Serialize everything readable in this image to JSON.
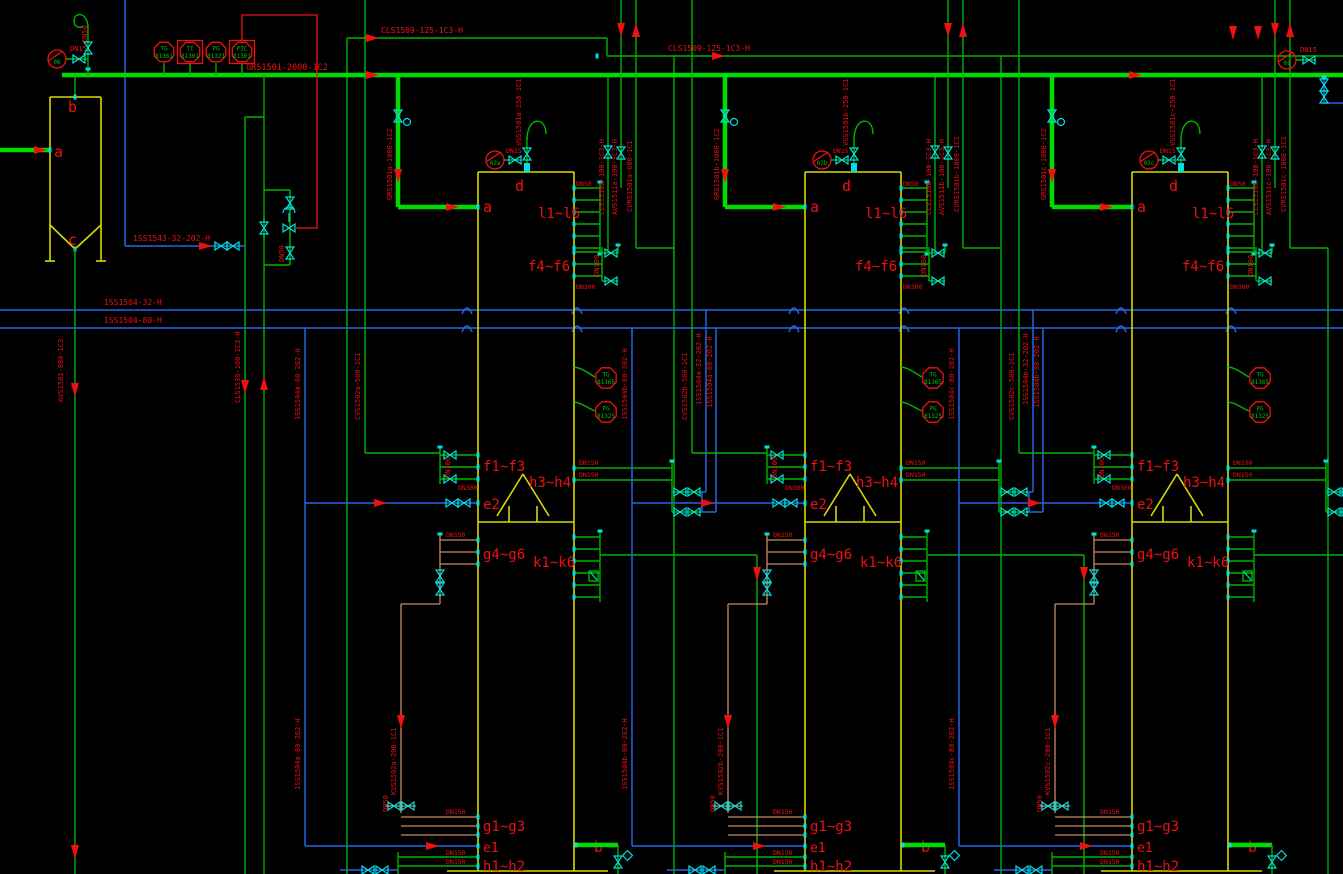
{
  "drawing": {
    "main_header_label": "GRS1501-2000-1C2",
    "cls_header_label": "CLS1509-125-1C3-H",
    "cls_header_label_2": "CLS1509-125-1C3-H",
    "blue_header_1": "1SS1504-32-H",
    "blue_header_2": "1SS1504-80-H",
    "blue_branch": "1SS1543-32-202-H",
    "avs_left": "AVS1501-800-1C3",
    "cls_left": "CLS1539-100-1C3-H",
    "left_inst": "06",
    "right_inst": "01",
    "dn15": "DN15",
    "dn50": "DN50",
    "dn100": "DN100",
    "dn150": "DN150",
    "dn300": "DN300",
    "vessel": {
      "top": "b",
      "inlet": "a",
      "bottom": "c"
    },
    "inst_row": [
      {
        "tag": "TG",
        "num": "81361"
      },
      {
        "tag": "TI",
        "num": "81301"
      },
      {
        "tag": "PG",
        "num": "81321"
      },
      {
        "tag": "PIC",
        "num": "81301"
      }
    ],
    "nozzles": {
      "top": "d",
      "inlet": "a",
      "outlet": "b",
      "e1": "e1",
      "e2": "e2",
      "l": "l1~l6",
      "f_upper": "f4~f6",
      "f_mid": "f1~f3",
      "h_mid": "h3~h4",
      "k": "k1~k6",
      "g_mid": "g4~g6",
      "g_bot": "g1~g3",
      "h_bot": "h1~h2"
    },
    "columns": [
      {
        "inst": "02a",
        "feed": "GRS1501a-1000-1C2",
        "vent": "VGS1501a-250-1C1",
        "cls": "CLS1510a-100-1C3-H",
        "avs": "AVS1511a-100-1C3-H",
        "cvrs": "CVRS1501a-600-1C1",
        "cvs": "CVS1502a-500-1C1",
        "kvs": "KVS1502a-200-1C1",
        "ss32": "1SS1504a-32-202-H",
        "ss80": "1SS1504a-80-202-H",
        "tg": "TG",
        "tg_num": "81365",
        "pg": "PG",
        "pg_num": "81325"
      },
      {
        "inst": "02b",
        "feed": "GRS1501b-1000-1C2",
        "vent": "VGS1501b-250-1C1",
        "cls": "CLS1510b-100-1C3-H",
        "avs": "AVS1511b-100-1C3-H",
        "cvrs": "CVRS1501b-1000-1C1",
        "cvs": "CVS1502b-500-1C1",
        "kvs": "KVS1502b-200-1C1",
        "ss32": "1SS1504b-32-202-H",
        "ss80": "1SS1504b-80-202-H",
        "tg": "TG",
        "tg_num": "81365",
        "pg": "PG",
        "pg_num": "81325"
      },
      {
        "inst": "02c",
        "feed": "GRS1501c-1000-1C2",
        "vent": "VGS1501c-250-1C1",
        "cls": "CLS1510c-100-1C3-H",
        "avs": "AVS1511c-100-1C3-H",
        "cvrs": "CVRS1501c-1000-1C1",
        "cvs": "CVS1502c-500-1C1",
        "kvs": "KVS1502c-200-1C1",
        "ss32": "1SS1504c-32-202-H",
        "ss80": "1SS1504c-80-202-H",
        "tg": "TG",
        "tg_num": "81365",
        "pg": "PG",
        "pg_num": "81325"
      }
    ]
  }
}
